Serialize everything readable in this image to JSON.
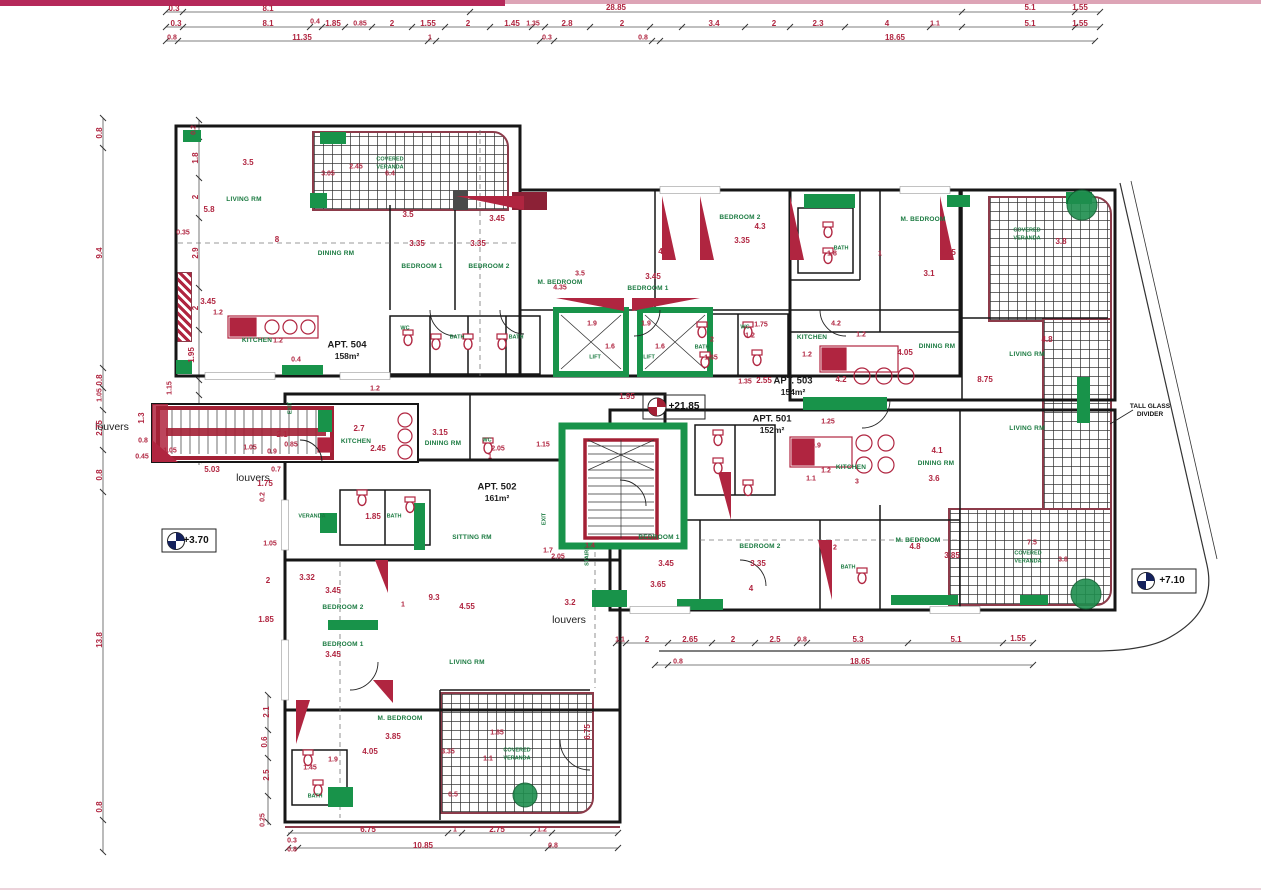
{
  "document": {
    "type": "Architectural floor plan - apartment level (scanned drawing)",
    "elevation_markers": [
      "+3.70",
      "+21.85",
      "+7.10"
    ]
  },
  "apartments": [
    {
      "label": "APT. 504",
      "area": "158m²"
    },
    {
      "label": "APT. 502",
      "area": "161m²"
    },
    {
      "label": "APT. 503",
      "area": "154m²"
    },
    {
      "label": "APT. 501",
      "area": "152m²"
    }
  ],
  "annotations": [
    "louvers",
    "louvers",
    "louvers",
    "TALL GLASS DIVIDER"
  ],
  "room_types": [
    "LIVING RM",
    "DINING RM",
    "SITTING RM",
    "KITCHEN",
    "BEDROOM 1",
    "BEDROOM 2",
    "M. BEDROOM",
    "BATH",
    "WC",
    "VERANDA",
    "COVERED VERANDA",
    "LIFT",
    "STAIRS",
    "EXIT"
  ],
  "colors": {
    "dimension_text": "#b02540",
    "room_text": "#1a7a40",
    "structure_green": "#18934a",
    "wall": "#161616",
    "veranda_trim": "#8c3b4a",
    "scan_bar": "#b5295a"
  },
  "labels": [
    {
      "t": "LIVING RM",
      "x": 244,
      "y": 200,
      "c": "room"
    },
    {
      "t": "DINING RM",
      "x": 336,
      "y": 254,
      "c": "room"
    },
    {
      "t": "KITCHEN",
      "x": 257,
      "y": 341,
      "c": "room"
    },
    {
      "t": "BEDROOM 1",
      "x": 422,
      "y": 267,
      "c": "room"
    },
    {
      "t": "BEDROOM 2",
      "x": 489,
      "y": 267,
      "c": "room"
    },
    {
      "t": "M. BEDROOM",
      "x": 560,
      "y": 283,
      "c": "room"
    },
    {
      "t": "BEDROOM 1",
      "x": 648,
      "y": 289,
      "c": "room"
    },
    {
      "t": "BEDROOM 2",
      "x": 740,
      "y": 218,
      "c": "room"
    },
    {
      "t": "BATH",
      "x": 841,
      "y": 249,
      "c": "roomxs"
    },
    {
      "t": "M. BEDROOM",
      "x": 923,
      "y": 220,
      "c": "room"
    },
    {
      "t": "COVERED",
      "x": 1027,
      "y": 231,
      "c": "roomxs"
    },
    {
      "t": "VERANDA",
      "x": 1027,
      "y": 239,
      "c": "roomxs"
    },
    {
      "t": "COVERED",
      "x": 390,
      "y": 160,
      "c": "roomxs"
    },
    {
      "t": "VERANDA",
      "x": 390,
      "y": 168,
      "c": "roomxs"
    },
    {
      "t": "DINING RM",
      "x": 937,
      "y": 347,
      "c": "room"
    },
    {
      "t": "LIVING RM",
      "x": 1027,
      "y": 355,
      "c": "room"
    },
    {
      "t": "LIVING RM",
      "x": 1027,
      "y": 429,
      "c": "room"
    },
    {
      "t": "KITCHEN",
      "x": 812,
      "y": 338,
      "c": "room"
    },
    {
      "t": "KITCHEN",
      "x": 851,
      "y": 468,
      "c": "room"
    },
    {
      "t": "DINING RM",
      "x": 936,
      "y": 464,
      "c": "room"
    },
    {
      "t": "BEDROOM 1",
      "x": 659,
      "y": 538,
      "c": "room"
    },
    {
      "t": "BEDROOM 2",
      "x": 760,
      "y": 547,
      "c": "room"
    },
    {
      "t": "M. BEDROOM",
      "x": 918,
      "y": 541,
      "c": "room"
    },
    {
      "t": "BATH",
      "x": 848,
      "y": 568,
      "c": "roomxs"
    },
    {
      "t": "WC",
      "x": 745,
      "y": 328,
      "c": "roomxs"
    },
    {
      "t": "BATH",
      "x": 702,
      "y": 348,
      "c": "roomxs"
    },
    {
      "t": "WC",
      "x": 405,
      "y": 329,
      "c": "roomxs"
    },
    {
      "t": "BATH",
      "x": 457,
      "y": 338,
      "c": "roomxs"
    },
    {
      "t": "BATH",
      "x": 516,
      "y": 338,
      "c": "roomxs"
    },
    {
      "t": "KITCHEN",
      "x": 356,
      "y": 442,
      "c": "room"
    },
    {
      "t": "DINING RM",
      "x": 443,
      "y": 444,
      "c": "room"
    },
    {
      "t": "WC",
      "x": 487,
      "y": 441,
      "c": "roomxs"
    },
    {
      "t": "VERANDA",
      "x": 312,
      "y": 517,
      "c": "roomxs"
    },
    {
      "t": "BATH",
      "x": 394,
      "y": 517,
      "c": "roomxs"
    },
    {
      "t": "SITTING RM",
      "x": 472,
      "y": 538,
      "c": "room"
    },
    {
      "t": "BEDROOM 2",
      "x": 343,
      "y": 608,
      "c": "room"
    },
    {
      "t": "BEDROOM 1",
      "x": 343,
      "y": 645,
      "c": "room"
    },
    {
      "t": "LIVING RM",
      "x": 467,
      "y": 663,
      "c": "room"
    },
    {
      "t": "M. BEDROOM",
      "x": 400,
      "y": 719,
      "c": "room"
    },
    {
      "t": "COVERED",
      "x": 517,
      "y": 751,
      "c": "roomxs"
    },
    {
      "t": "VERANDA",
      "x": 517,
      "y": 759,
      "c": "roomxs"
    },
    {
      "t": "BATH",
      "x": 315,
      "y": 797,
      "c": "roomxs"
    },
    {
      "t": "COVERED",
      "x": 1028,
      "y": 554,
      "c": "roomxs"
    },
    {
      "t": "VERANDA",
      "x": 1028,
      "y": 562,
      "c": "roomxs"
    },
    {
      "t": "LIFT",
      "x": 595,
      "y": 358,
      "c": "roomxs"
    },
    {
      "t": "LIFT",
      "x": 649,
      "y": 358,
      "c": "roomxs"
    },
    {
      "t": "STAIRS",
      "x": 588,
      "y": 556,
      "c": "roomxs rot"
    },
    {
      "t": "EXIT",
      "x": 291,
      "y": 408,
      "c": "roomxs rot"
    },
    {
      "t": "EXIT",
      "x": 545,
      "y": 519,
      "c": "roomxs rot"
    },
    {
      "t": "louvers",
      "x": 112,
      "y": 427,
      "c": "lvr"
    },
    {
      "t": "louvers",
      "x": 253,
      "y": 478,
      "c": "lvr"
    },
    {
      "t": "louvers",
      "x": 569,
      "y": 620,
      "c": "lvr"
    },
    {
      "t": "TALL GLASS",
      "x": 1150,
      "y": 407,
      "c": "note"
    },
    {
      "t": "DIVIDER",
      "x": 1150,
      "y": 415,
      "c": "note"
    },
    {
      "t": "APT. 504",
      "x": 347,
      "y": 345,
      "c": "apt"
    },
    {
      "t": "158m²",
      "x": 347,
      "y": 356,
      "c": "apt2"
    },
    {
      "t": "APT. 502",
      "x": 497,
      "y": 487,
      "c": "apt"
    },
    {
      "t": "161m²",
      "x": 497,
      "y": 498,
      "c": "apt2"
    },
    {
      "t": "APT. 503",
      "x": 793,
      "y": 381,
      "c": "apt"
    },
    {
      "t": "154m²",
      "x": 793,
      "y": 392,
      "c": "apt2"
    },
    {
      "t": "APT. 501",
      "x": 772,
      "y": 419,
      "c": "apt"
    },
    {
      "t": "152m²",
      "x": 772,
      "y": 430,
      "c": "apt2"
    },
    {
      "t": "+3.70",
      "x": 196,
      "y": 541,
      "c": "elev"
    },
    {
      "t": "+21.85",
      "x": 684,
      "y": 407,
      "c": "elev"
    },
    {
      "t": "+7.10",
      "x": 1172,
      "y": 581,
      "c": "elev"
    },
    {
      "t": "0.3",
      "x": 174,
      "y": 9
    },
    {
      "t": "8.1",
      "x": 268,
      "y": 9
    },
    {
      "t": "28.85",
      "x": 616,
      "y": 8
    },
    {
      "t": "5.1",
      "x": 1030,
      "y": 8
    },
    {
      "t": "1.55",
      "x": 1080,
      "y": 8
    },
    {
      "t": "0.3",
      "x": 176,
      "y": 24
    },
    {
      "t": "8.1",
      "x": 268,
      "y": 24
    },
    {
      "t": "0.4",
      "x": 315,
      "y": 22,
      "c": "dimxs"
    },
    {
      "t": "1.85",
      "x": 333,
      "y": 24
    },
    {
      "t": "0.85",
      "x": 360,
      "y": 24,
      "c": "dimxs"
    },
    {
      "t": "2",
      "x": 392,
      "y": 24
    },
    {
      "t": "1.55",
      "x": 428,
      "y": 24
    },
    {
      "t": "2",
      "x": 468,
      "y": 24
    },
    {
      "t": "1.45",
      "x": 512,
      "y": 24
    },
    {
      "t": "1.35",
      "x": 533,
      "y": 24,
      "c": "dimxs"
    },
    {
      "t": "2.8",
      "x": 567,
      "y": 24
    },
    {
      "t": "2",
      "x": 622,
      "y": 24
    },
    {
      "t": "3.4",
      "x": 714,
      "y": 24
    },
    {
      "t": "2",
      "x": 774,
      "y": 24
    },
    {
      "t": "2.3",
      "x": 818,
      "y": 24
    },
    {
      "t": "4",
      "x": 887,
      "y": 24
    },
    {
      "t": "1.1",
      "x": 935,
      "y": 24,
      "c": "dimxs"
    },
    {
      "t": "5.1",
      "x": 1030,
      "y": 24
    },
    {
      "t": "1.55",
      "x": 1080,
      "y": 24
    },
    {
      "t": "0.8",
      "x": 172,
      "y": 38,
      "c": "dimxs"
    },
    {
      "t": "11.35",
      "x": 302,
      "y": 38
    },
    {
      "t": "1",
      "x": 430,
      "y": 38,
      "c": "dimxs"
    },
    {
      "t": "0.3",
      "x": 547,
      "y": 38,
      "c": "dimxs"
    },
    {
      "t": "0.8",
      "x": 643,
      "y": 38,
      "c": "dimxs"
    },
    {
      "t": "18.65",
      "x": 895,
      "y": 38
    },
    {
      "t": "0.8",
      "x": 100,
      "y": 133,
      "c": "dim rot"
    },
    {
      "t": "9.4",
      "x": 100,
      "y": 253,
      "c": "dim rot"
    },
    {
      "t": "0.8",
      "x": 100,
      "y": 380,
      "c": "dim rot"
    },
    {
      "t": "1.05",
      "x": 100,
      "y": 395,
      "c": "dimxs rot"
    },
    {
      "t": "2.75",
      "x": 100,
      "y": 428,
      "c": "dim rot"
    },
    {
      "t": "0.8",
      "x": 100,
      "y": 475,
      "c": "dim rot"
    },
    {
      "t": "13.8",
      "x": 100,
      "y": 640,
      "c": "dim rot"
    },
    {
      "t": "0.8",
      "x": 100,
      "y": 807,
      "c": "dim rot"
    },
    {
      "t": "0.2",
      "x": 194,
      "y": 130,
      "c": "dimxs rot"
    },
    {
      "t": "1.8",
      "x": 196,
      "y": 158,
      "c": "dim rot"
    },
    {
      "t": "2",
      "x": 196,
      "y": 197,
      "c": "dim rot"
    },
    {
      "t": "2.9",
      "x": 196,
      "y": 253,
      "c": "dim rot"
    },
    {
      "t": "2",
      "x": 196,
      "y": 308,
      "c": "dim rot"
    },
    {
      "t": "1.95",
      "x": 192,
      "y": 355,
      "c": "dim rot"
    },
    {
      "t": "1.15",
      "x": 170,
      "y": 388,
      "c": "dimxs rot"
    },
    {
      "t": "1.3",
      "x": 142,
      "y": 418,
      "c": "dim rot"
    },
    {
      "t": "0.8",
      "x": 143,
      "y": 441,
      "c": "dimxs"
    },
    {
      "t": "0.45",
      "x": 142,
      "y": 457,
      "c": "dimxs"
    },
    {
      "t": "1.05",
      "x": 170,
      "y": 451,
      "c": "dimxs"
    },
    {
      "t": "5.03",
      "x": 212,
      "y": 470
    },
    {
      "t": "1.05",
      "x": 250,
      "y": 448,
      "c": "dimxs"
    },
    {
      "t": "2.1",
      "x": 282,
      "y": 435
    },
    {
      "t": "0.85",
      "x": 291,
      "y": 445,
      "c": "dimxs"
    },
    {
      "t": "0.9",
      "x": 272,
      "y": 452,
      "c": "dimxs"
    },
    {
      "t": "0.7",
      "x": 276,
      "y": 470,
      "c": "dimxs"
    },
    {
      "t": "1.75",
      "x": 265,
      "y": 484
    },
    {
      "t": "0.2",
      "x": 263,
      "y": 497,
      "c": "dimxs rot"
    },
    {
      "t": "3.05",
      "x": 328,
      "y": 174,
      "c": "dimxs"
    },
    {
      "t": "2.45",
      "x": 356,
      "y": 167,
      "c": "dimxs"
    },
    {
      "t": "6.4",
      "x": 390,
      "y": 174,
      "c": "dimxs"
    },
    {
      "t": "3.5",
      "x": 248,
      "y": 163
    },
    {
      "t": "5.8",
      "x": 209,
      "y": 210
    },
    {
      "t": "0.35",
      "x": 183,
      "y": 233,
      "c": "dimxs"
    },
    {
      "t": "8",
      "x": 277,
      "y": 240
    },
    {
      "t": "3.45",
      "x": 208,
      "y": 302
    },
    {
      "t": "1.2",
      "x": 218,
      "y": 313,
      "c": "dimxs"
    },
    {
      "t": "1.2",
      "x": 278,
      "y": 341,
      "c": "dimxs"
    },
    {
      "t": "0.4",
      "x": 296,
      "y": 360,
      "c": "dimxs"
    },
    {
      "t": "1.2",
      "x": 375,
      "y": 389,
      "c": "dimxs"
    },
    {
      "t": "3.5",
      "x": 408,
      "y": 215
    },
    {
      "t": "3.35",
      "x": 417,
      "y": 244
    },
    {
      "t": "3.45",
      "x": 497,
      "y": 219
    },
    {
      "t": "3.35",
      "x": 478,
      "y": 244
    },
    {
      "t": "4.35",
      "x": 666,
      "y": 252
    },
    {
      "t": "3.45",
      "x": 653,
      "y": 277
    },
    {
      "t": "3.5",
      "x": 580,
      "y": 274,
      "c": "dimxs"
    },
    {
      "t": "4.35",
      "x": 560,
      "y": 288,
      "c": "dimxs"
    },
    {
      "t": "4.3",
      "x": 760,
      "y": 227
    },
    {
      "t": "3.35",
      "x": 742,
      "y": 241
    },
    {
      "t": "1.8",
      "x": 832,
      "y": 254,
      "c": "dimxs"
    },
    {
      "t": "1",
      "x": 880,
      "y": 254,
      "c": "dimxs"
    },
    {
      "t": "3.1",
      "x": 929,
      "y": 274
    },
    {
      "t": "4.45",
      "x": 948,
      "y": 253
    },
    {
      "t": "3.8",
      "x": 1061,
      "y": 242
    },
    {
      "t": "1.75",
      "x": 761,
      "y": 325,
      "c": "dimxs"
    },
    {
      "t": "2",
      "x": 712,
      "y": 340,
      "c": "dimxs"
    },
    {
      "t": "1.65",
      "x": 711,
      "y": 358,
      "c": "dimxs"
    },
    {
      "t": "1.2",
      "x": 750,
      "y": 336,
      "c": "dimxs"
    },
    {
      "t": "1.9",
      "x": 592,
      "y": 324,
      "c": "dimxs"
    },
    {
      "t": "1.9",
      "x": 646,
      "y": 324,
      "c": "dimxs"
    },
    {
      "t": "1.6",
      "x": 610,
      "y": 347,
      "c": "dimxs"
    },
    {
      "t": "1.6",
      "x": 660,
      "y": 347,
      "c": "dimxs"
    },
    {
      "t": "1.95",
      "x": 627,
      "y": 397
    },
    {
      "t": "2.55",
      "x": 764,
      "y": 381
    },
    {
      "t": "1.35",
      "x": 745,
      "y": 382,
      "c": "dimxs"
    },
    {
      "t": "1.25",
      "x": 828,
      "y": 422,
      "c": "dimxs"
    },
    {
      "t": "4.2",
      "x": 836,
      "y": 324,
      "c": "dimxs"
    },
    {
      "t": "1.2",
      "x": 861,
      "y": 335,
      "c": "dimxs"
    },
    {
      "t": "1.2",
      "x": 807,
      "y": 355,
      "c": "dimxs"
    },
    {
      "t": "4.05",
      "x": 905,
      "y": 353
    },
    {
      "t": "4.2",
      "x": 841,
      "y": 380
    },
    {
      "t": "8.75",
      "x": 985,
      "y": 380
    },
    {
      "t": "4.8",
      "x": 1047,
      "y": 340
    },
    {
      "t": "0.9",
      "x": 816,
      "y": 446,
      "c": "dimxs"
    },
    {
      "t": "1.2",
      "x": 826,
      "y": 471,
      "c": "dimxs"
    },
    {
      "t": "4.1",
      "x": 937,
      "y": 451
    },
    {
      "t": "3.6",
      "x": 934,
      "y": 479
    },
    {
      "t": "1.1",
      "x": 811,
      "y": 479,
      "c": "dimxs"
    },
    {
      "t": "3",
      "x": 857,
      "y": 482,
      "c": "dimxs"
    },
    {
      "t": "3.45",
      "x": 666,
      "y": 564
    },
    {
      "t": "3.65",
      "x": 658,
      "y": 585
    },
    {
      "t": "3.35",
      "x": 758,
      "y": 564
    },
    {
      "t": "4",
      "x": 751,
      "y": 589
    },
    {
      "t": "2",
      "x": 835,
      "y": 548,
      "c": "dimxs"
    },
    {
      "t": "4.8",
      "x": 915,
      "y": 547
    },
    {
      "t": "3.85",
      "x": 952,
      "y": 556
    },
    {
      "t": "7.5",
      "x": 1032,
      "y": 543,
      "c": "dimxs"
    },
    {
      "t": "3.8",
      "x": 1063,
      "y": 560,
      "c": "dimxs"
    },
    {
      "t": "1.1",
      "x": 620,
      "y": 640,
      "c": "dimxs"
    },
    {
      "t": "2",
      "x": 647,
      "y": 640
    },
    {
      "t": "2.65",
      "x": 690,
      "y": 640
    },
    {
      "t": "2",
      "x": 733,
      "y": 640
    },
    {
      "t": "2.5",
      "x": 775,
      "y": 640
    },
    {
      "t": "0.8",
      "x": 802,
      "y": 640,
      "c": "dimxs"
    },
    {
      "t": "5.3",
      "x": 858,
      "y": 640
    },
    {
      "t": "5.1",
      "x": 956,
      "y": 640
    },
    {
      "t": "1.55",
      "x": 1018,
      "y": 639
    },
    {
      "t": "0.8",
      "x": 678,
      "y": 662,
      "c": "dimxs"
    },
    {
      "t": "18.65",
      "x": 860,
      "y": 662
    },
    {
      "t": "2.7",
      "x": 359,
      "y": 429
    },
    {
      "t": "3.15",
      "x": 440,
      "y": 433
    },
    {
      "t": "2.45",
      "x": 378,
      "y": 449
    },
    {
      "t": "2.05",
      "x": 498,
      "y": 449,
      "c": "dimxs"
    },
    {
      "t": "1",
      "x": 490,
      "y": 457,
      "c": "dimxs"
    },
    {
      "t": "1.85",
      "x": 373,
      "y": 517
    },
    {
      "t": "1.05",
      "x": 270,
      "y": 544,
      "c": "dimxs"
    },
    {
      "t": "2",
      "x": 268,
      "y": 581
    },
    {
      "t": "1.85",
      "x": 266,
      "y": 620
    },
    {
      "t": "3.32",
      "x": 307,
      "y": 578
    },
    {
      "t": "3.45",
      "x": 333,
      "y": 591
    },
    {
      "t": "9.3",
      "x": 434,
      "y": 598
    },
    {
      "t": "4.55",
      "x": 467,
      "y": 607
    },
    {
      "t": "1",
      "x": 403,
      "y": 605,
      "c": "dimxs"
    },
    {
      "t": "3.45",
      "x": 333,
      "y": 655
    },
    {
      "t": "3.2",
      "x": 570,
      "y": 603
    },
    {
      "t": "1.7",
      "x": 548,
      "y": 551,
      "c": "dimxs"
    },
    {
      "t": "1.4",
      "x": 590,
      "y": 546,
      "c": "dimxs"
    },
    {
      "t": "2.05",
      "x": 558,
      "y": 557,
      "c": "dimxs"
    },
    {
      "t": "1.15",
      "x": 543,
      "y": 445,
      "c": "dimxs"
    },
    {
      "t": "3.85",
      "x": 393,
      "y": 737
    },
    {
      "t": "4.05",
      "x": 370,
      "y": 752
    },
    {
      "t": "1.9",
      "x": 333,
      "y": 760,
      "c": "dimxs"
    },
    {
      "t": "1.45",
      "x": 310,
      "y": 768,
      "c": "dimxs"
    },
    {
      "t": "3.35",
      "x": 448,
      "y": 752,
      "c": "dimxs"
    },
    {
      "t": "1.85",
      "x": 497,
      "y": 733,
      "c": "dimxs"
    },
    {
      "t": "1.1",
      "x": 488,
      "y": 759,
      "c": "dimxs"
    },
    {
      "t": "0.5",
      "x": 453,
      "y": 795,
      "c": "dimxs"
    },
    {
      "t": "6.75",
      "x": 588,
      "y": 732,
      "c": "dim rot"
    },
    {
      "t": "2.1",
      "x": 267,
      "y": 712,
      "c": "dim rot"
    },
    {
      "t": "0.6",
      "x": 265,
      "y": 742,
      "c": "dim rot"
    },
    {
      "t": "2.5",
      "x": 267,
      "y": 775,
      "c": "dim rot"
    },
    {
      "t": "0.25",
      "x": 263,
      "y": 820,
      "c": "dimxs rot"
    },
    {
      "t": "6.75",
      "x": 368,
      "y": 830
    },
    {
      "t": "1",
      "x": 455,
      "y": 830,
      "c": "dimxs"
    },
    {
      "t": "2.75",
      "x": 497,
      "y": 830
    },
    {
      "t": "1.2",
      "x": 542,
      "y": 830,
      "c": "dimxs"
    },
    {
      "t": "0.3",
      "x": 292,
      "y": 841,
      "c": "dimxs"
    },
    {
      "t": "0.8",
      "x": 292,
      "y": 850,
      "c": "dimxs"
    },
    {
      "t": "10.85",
      "x": 423,
      "y": 846
    },
    {
      "t": "0.8",
      "x": 553,
      "y": 846,
      "c": "dimxs"
    }
  ]
}
